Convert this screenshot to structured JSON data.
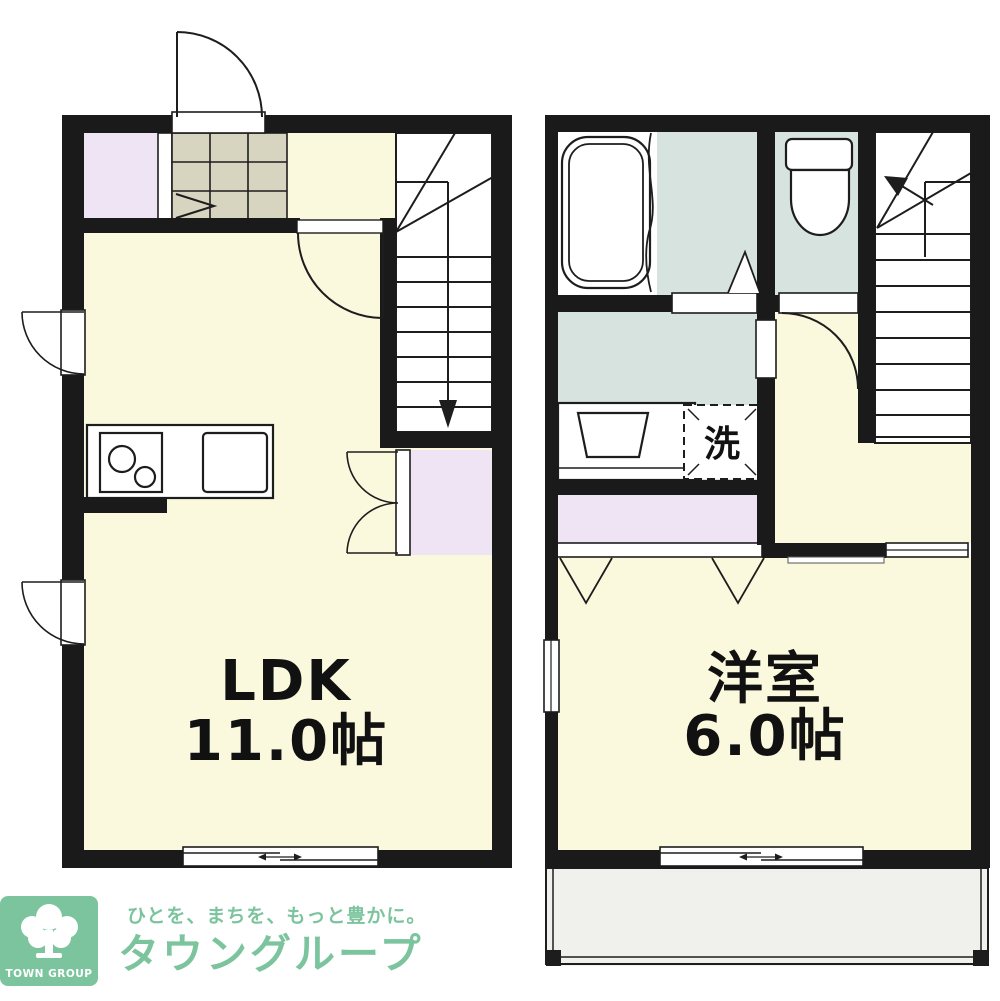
{
  "floorplan": {
    "floor1": {
      "room_label": {
        "line1": "LDK",
        "line2": "11.0帖"
      }
    },
    "floor2": {
      "room_label": {
        "line1": "洋室",
        "line2": "6.0帖"
      },
      "laundry_label": "洗"
    },
    "colors": {
      "wall": "#1a1a1a",
      "room_yellow": "#FAF8DD",
      "closet_purple": "#EFE4F4",
      "wet_blue": "#D6E3DF",
      "tile_grey": "#D7D4C0",
      "balcony_grey": "#F0F0ED",
      "logo_green": "#7CC49E"
    },
    "logo": {
      "badge_text": "TOWN GROUP",
      "tagline": "ひとを、まちを、もっと豊かに。",
      "brand": "タウングループ"
    }
  }
}
